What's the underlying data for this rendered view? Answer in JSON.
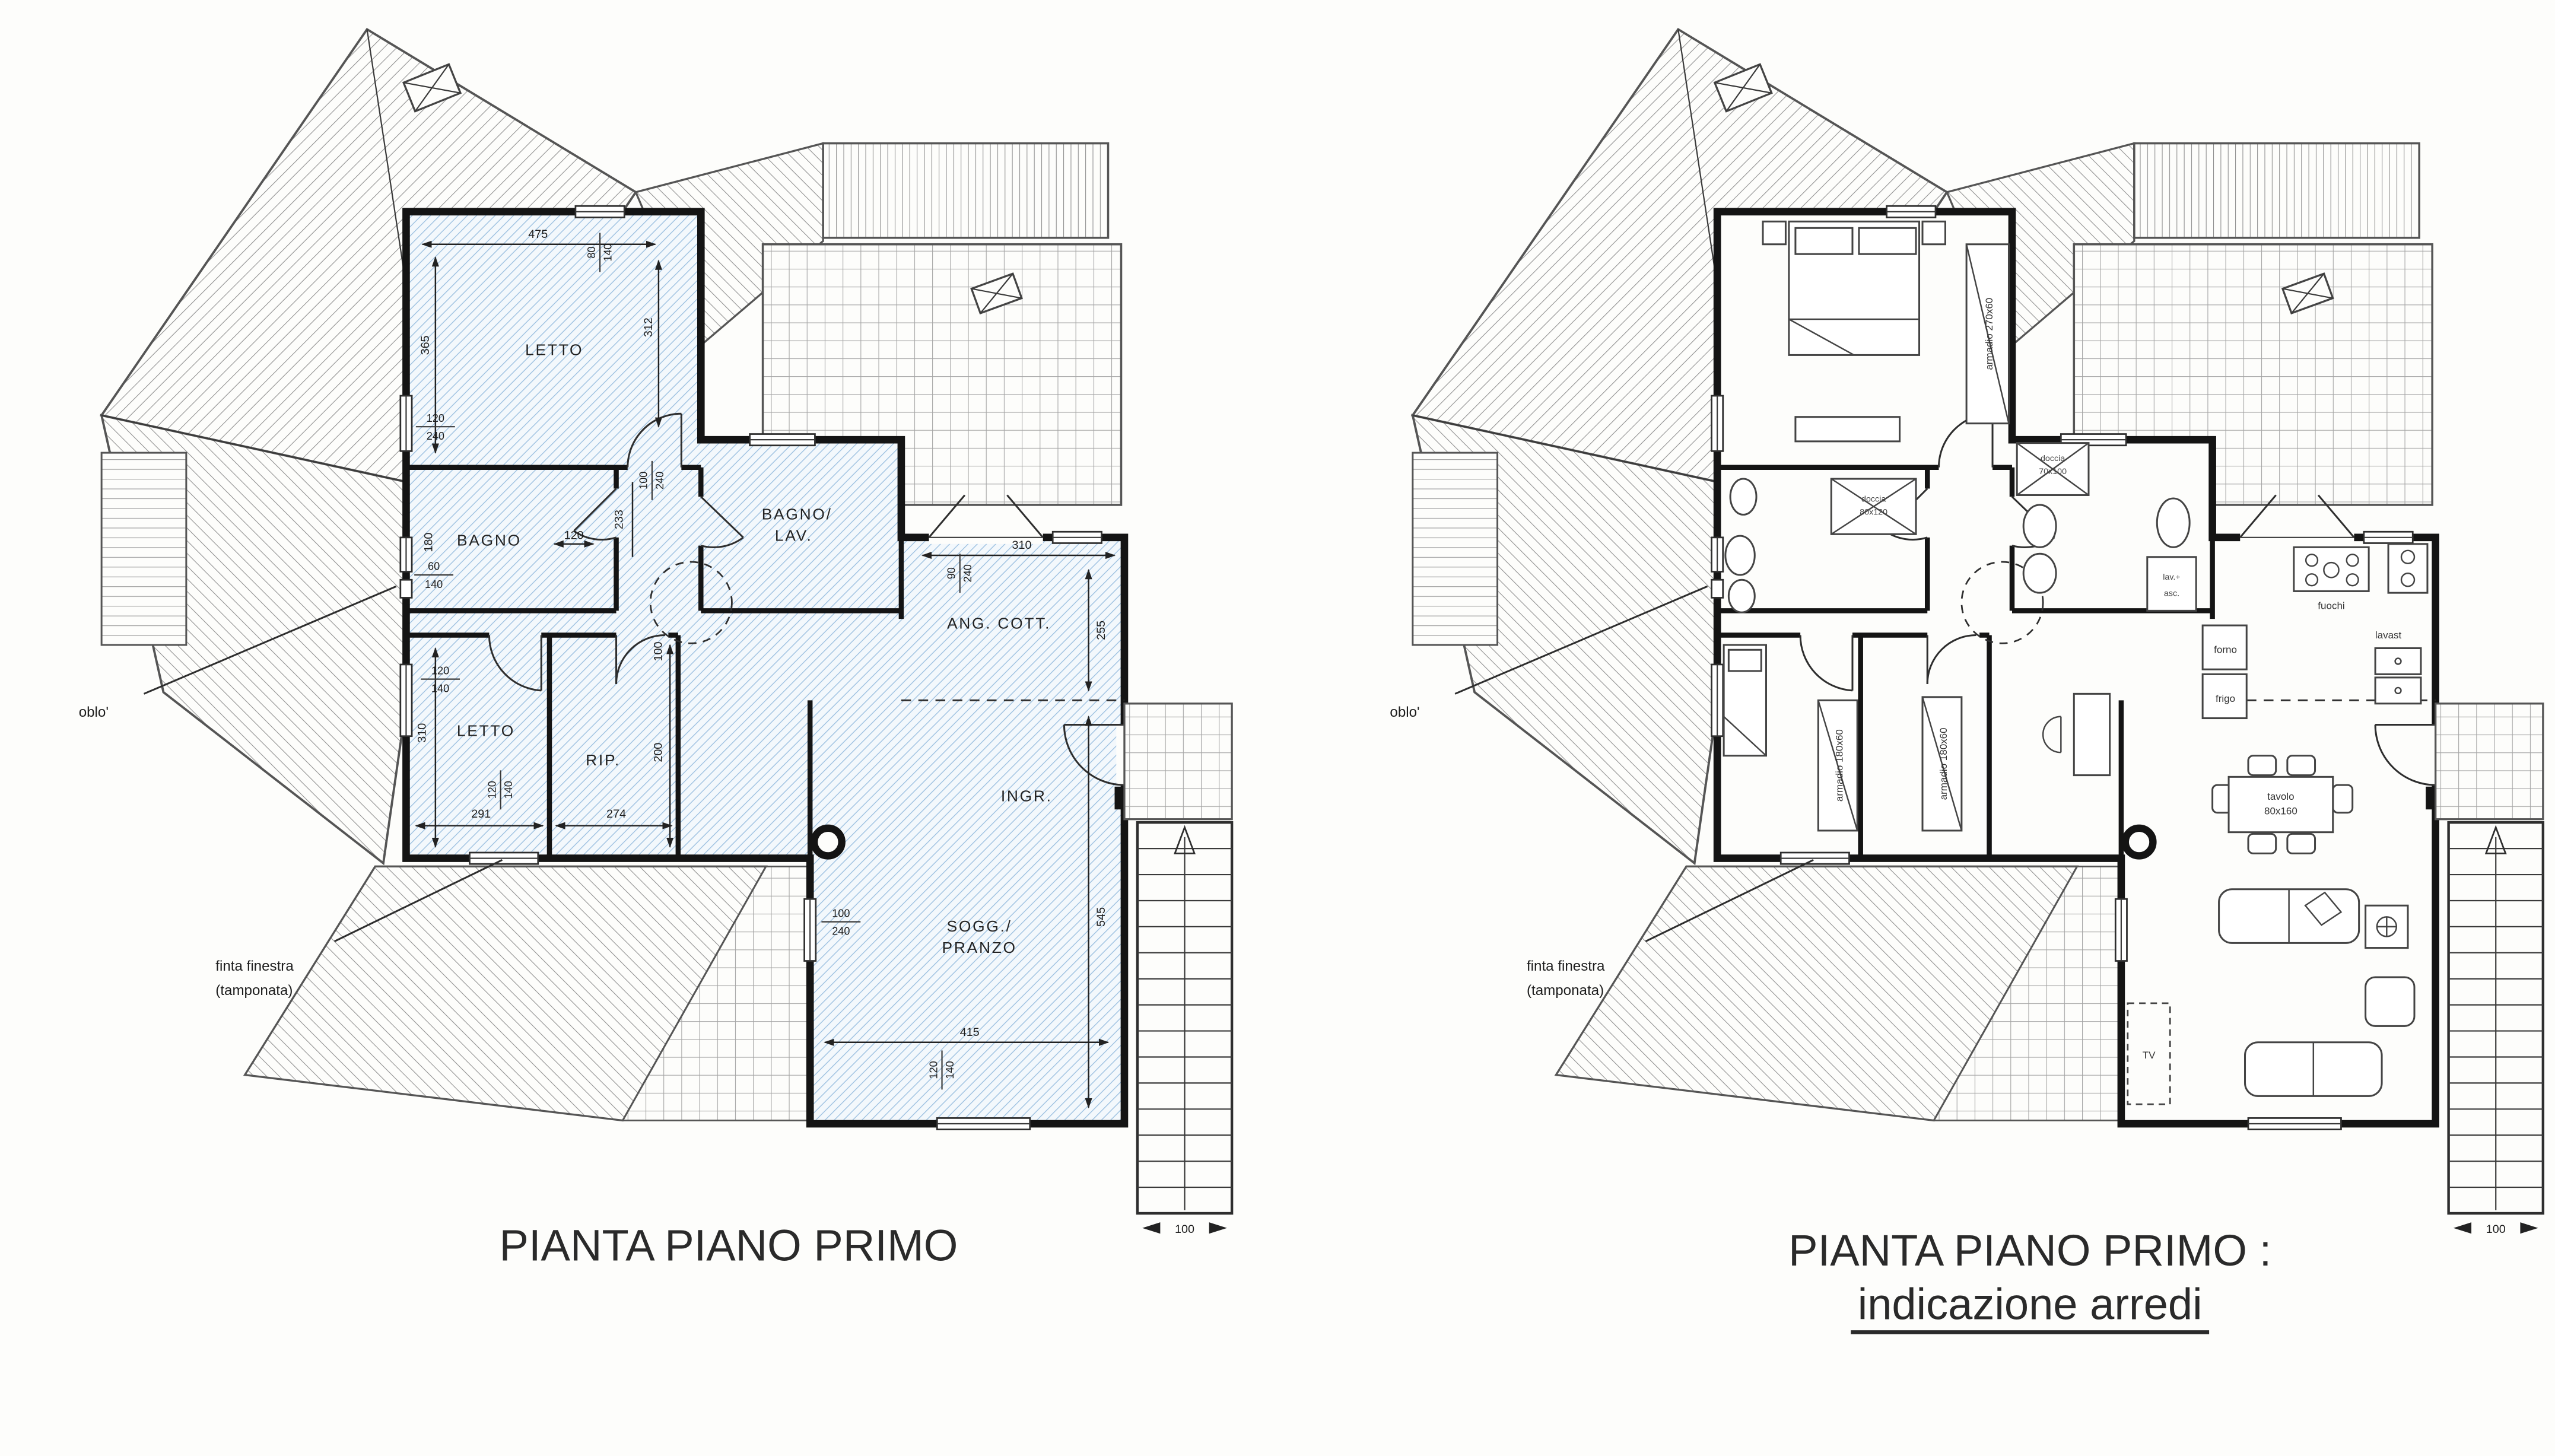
{
  "left": {
    "title": "PIANTA PIANO PRIMO",
    "rooms": {
      "letto1": "LETTO",
      "bagno": "BAGNO",
      "bagno_lav_line1": "BAGNO/",
      "bagno_lav_line2": "LAV.",
      "ang_cott": "ANG. COTT.",
      "letto2": "LETTO",
      "rip": "RIP.",
      "ingr": "INGR.",
      "sogg_line1": "SOGG./",
      "sogg_line2": "PRANZO"
    },
    "dims": {
      "top_width": "475",
      "top_window_w": "80",
      "top_window_h": "140",
      "letto1_height": "365",
      "terrace_height": "312",
      "letto1_door_w": "120",
      "letto1_door_h": "240",
      "upper_window_w": "100",
      "upper_window_h": "240",
      "bagno_height": "180",
      "bagno_window_w": "60",
      "bagno_window_h": "140",
      "hall_door": "120",
      "hall_length": "233",
      "hall_window_w": "100",
      "hall_window_h": "240",
      "hall_width": "100",
      "cott_window_w": "90",
      "cott_window_h": "240",
      "cott_width": "310",
      "cott_height": "255",
      "letto2_window_w": "120",
      "letto2_window_h": "140",
      "letto2_height": "310",
      "letto2_width": "291",
      "letto2_bottom_window_w": "120",
      "letto2_bottom_window_h": "140",
      "rip_width": "274",
      "rip_height": "200",
      "sogg_window_w": "100",
      "sogg_window_h": "240",
      "sogg_height": "545",
      "sogg_width": "415",
      "sogg_bottom_window_w": "120",
      "sogg_bottom_window_h": "140",
      "stair_width": "100"
    },
    "annotations": {
      "oblo": "oblo'",
      "finta_line1": "finta finestra",
      "finta_line2": "(tamponata)"
    }
  },
  "right": {
    "title_line1": "PIANTA PIANO PRIMO :",
    "title_line2": "indicazione arredi",
    "furniture": {
      "armadio_letto1": "armadio 270x60",
      "armadio_letto2": "armadio 180x60",
      "armadio_studio": "armadio 180x60",
      "doccia_bagno_line1": "doccia",
      "doccia_bagno_line2": "80x120",
      "doccia_lav_line1": "doccia",
      "doccia_lav_line2": "70x100",
      "lav_asc_line1": "lav.+",
      "lav_asc_line2": "asc.",
      "fuochi": "fuochi",
      "lavast": "lavast",
      "forno": "forno",
      "frigo": "frigo",
      "tavolo_line1": "tavolo",
      "tavolo_line2": "80x160",
      "tv": "TV"
    },
    "annotations": {
      "oblo": "oblo'",
      "finta_line1": "finta finestra",
      "finta_line2": "(tamponata)",
      "stair_width": "100"
    }
  },
  "colors": {
    "floor_hatch_blue": "#9cc0e0",
    "wall_black": "#141414",
    "roof_hatch_gray": "#909090"
  }
}
